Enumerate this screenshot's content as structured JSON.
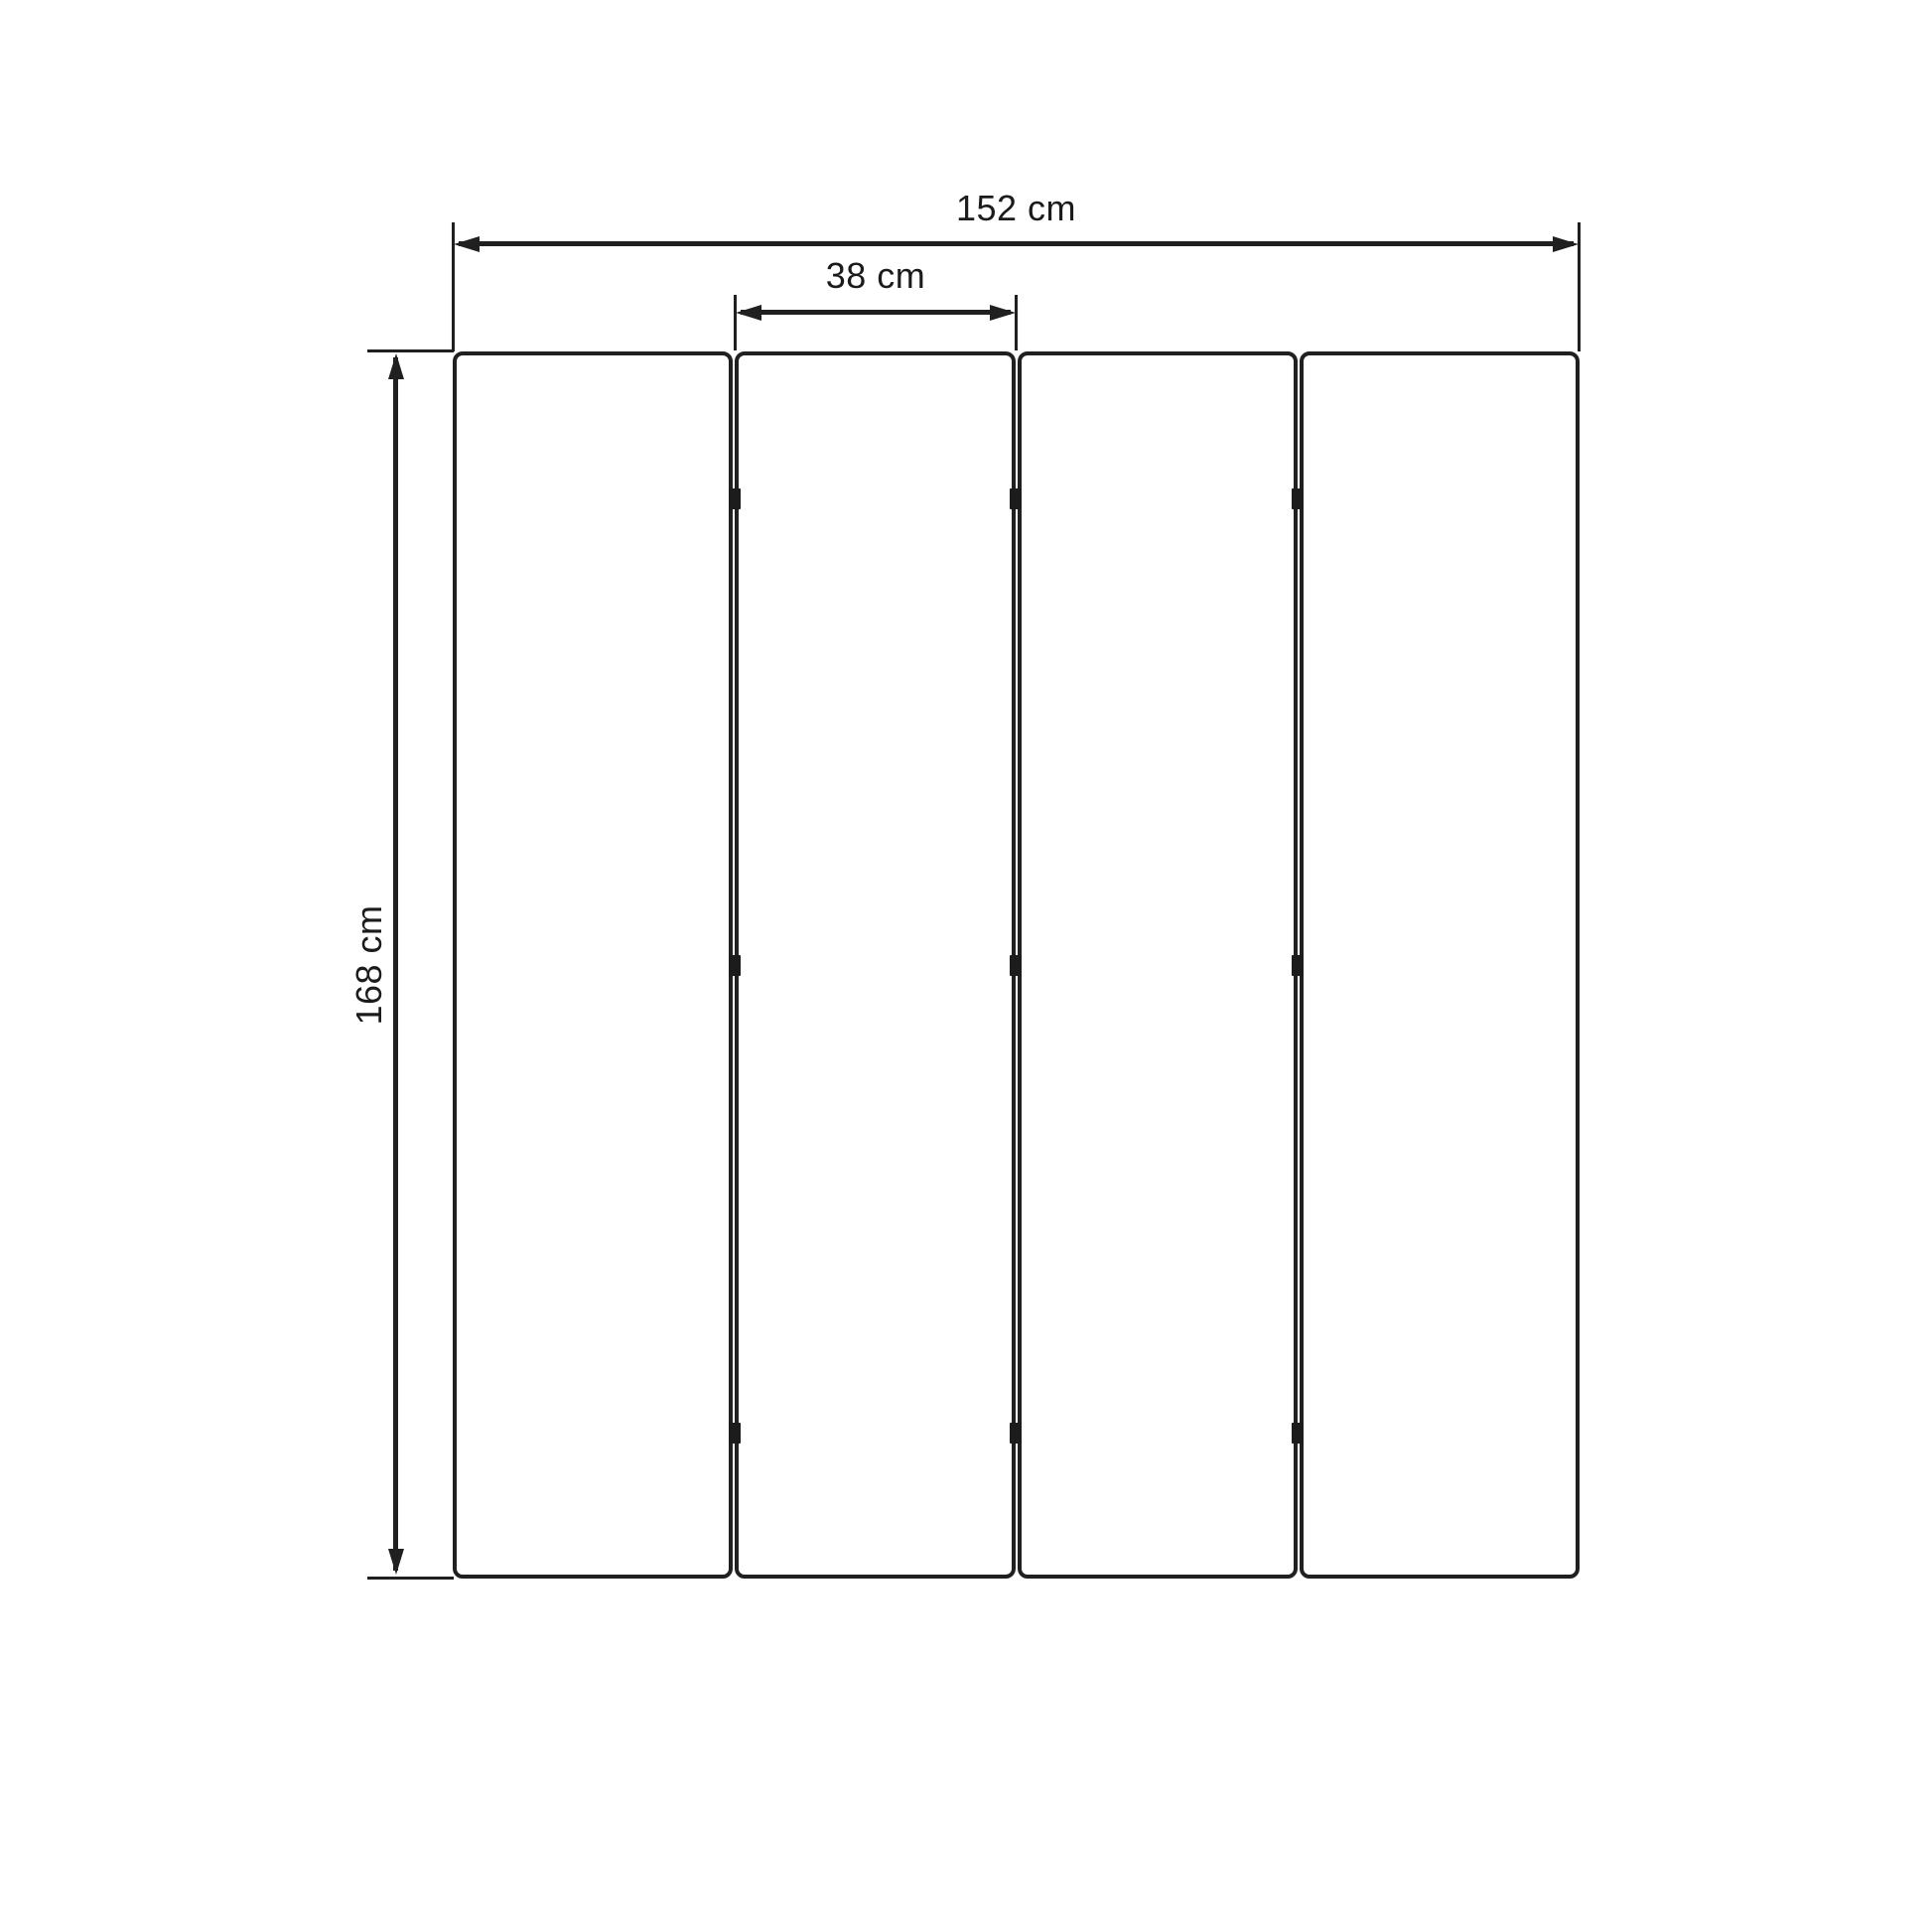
{
  "diagram": {
    "type": "technical-dimension-drawing",
    "subject": "4-panel folding screen, front elevation",
    "panel_count": 4,
    "hinge_rows": 3,
    "hinge_marks_total": 9,
    "colors": {
      "background": "#ffffff",
      "line": "#202020",
      "text": "#1b1b1b"
    },
    "dimensions": {
      "total_width": {
        "label": "152 cm",
        "value": 152,
        "unit": "cm"
      },
      "panel_width": {
        "label": "38 cm",
        "value": 38,
        "unit": "cm"
      },
      "panel_height": {
        "label": "168 cm",
        "value": 168,
        "unit": "cm"
      }
    }
  }
}
